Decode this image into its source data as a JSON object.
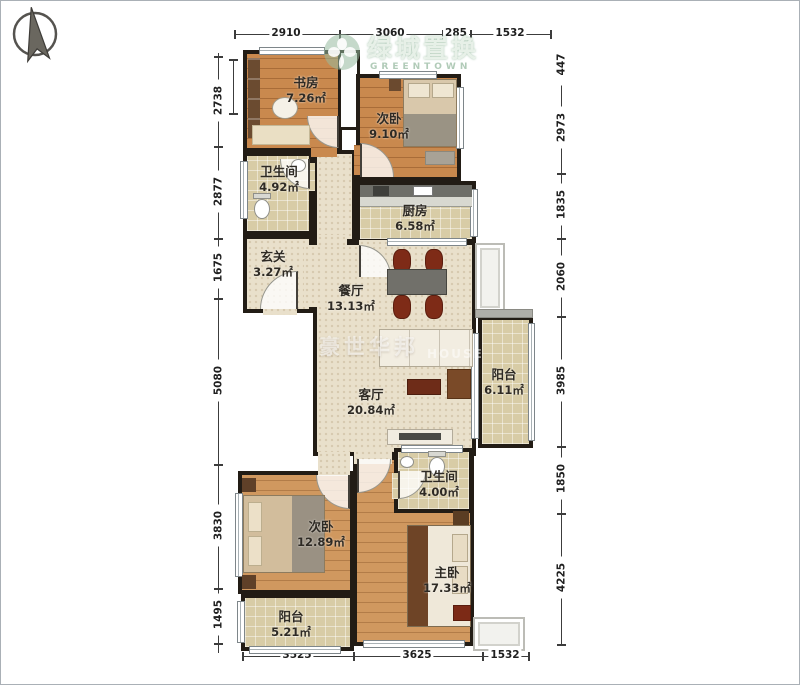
{
  "meta": {
    "type": "apartment-floorplan"
  },
  "compass": {
    "label": "north-compass"
  },
  "watermarks": {
    "top": {
      "brand": "绿城置换",
      "sub": "GREENTOWN"
    },
    "center": {
      "brand": "豪世华邦",
      "sub": "HOUSE"
    }
  },
  "rooms": [
    {
      "name": "书房",
      "area": "7.26㎡"
    },
    {
      "name": "次卧",
      "area": "9.10㎡"
    },
    {
      "name": "卫生间",
      "area": "4.92㎡"
    },
    {
      "name": "厨房",
      "area": "6.58㎡"
    },
    {
      "name": "玄关",
      "area": "3.27㎡"
    },
    {
      "name": "餐厅",
      "area": "13.13㎡"
    },
    {
      "name": "客厅",
      "area": "20.84㎡"
    },
    {
      "name": "阳台",
      "area": "6.11㎡"
    },
    {
      "name": "卫生间",
      "area": "4.00㎡"
    },
    {
      "name": "次卧",
      "area": "12.89㎡"
    },
    {
      "name": "主卧",
      "area": "17.33㎡"
    },
    {
      "name": "阳台",
      "area": "5.21㎡"
    }
  ],
  "dimensions": {
    "top": [
      "2910",
      "3060",
      "285",
      "1532"
    ],
    "bottom": [
      "3525",
      "3625",
      "1532"
    ],
    "left": [
      "2738",
      "2877",
      "1675",
      "5080",
      "3830",
      "1495"
    ],
    "right": [
      "447",
      "2973",
      "1835",
      "2060",
      "3985",
      "1850",
      "4225"
    ]
  },
  "colors": {
    "wall": "#221c15",
    "wood_floor": "#c9894e",
    "tile_floor": "#d8cca6",
    "hall_floor": "#e9e0cb",
    "brand_green": "#9fc3a8"
  }
}
